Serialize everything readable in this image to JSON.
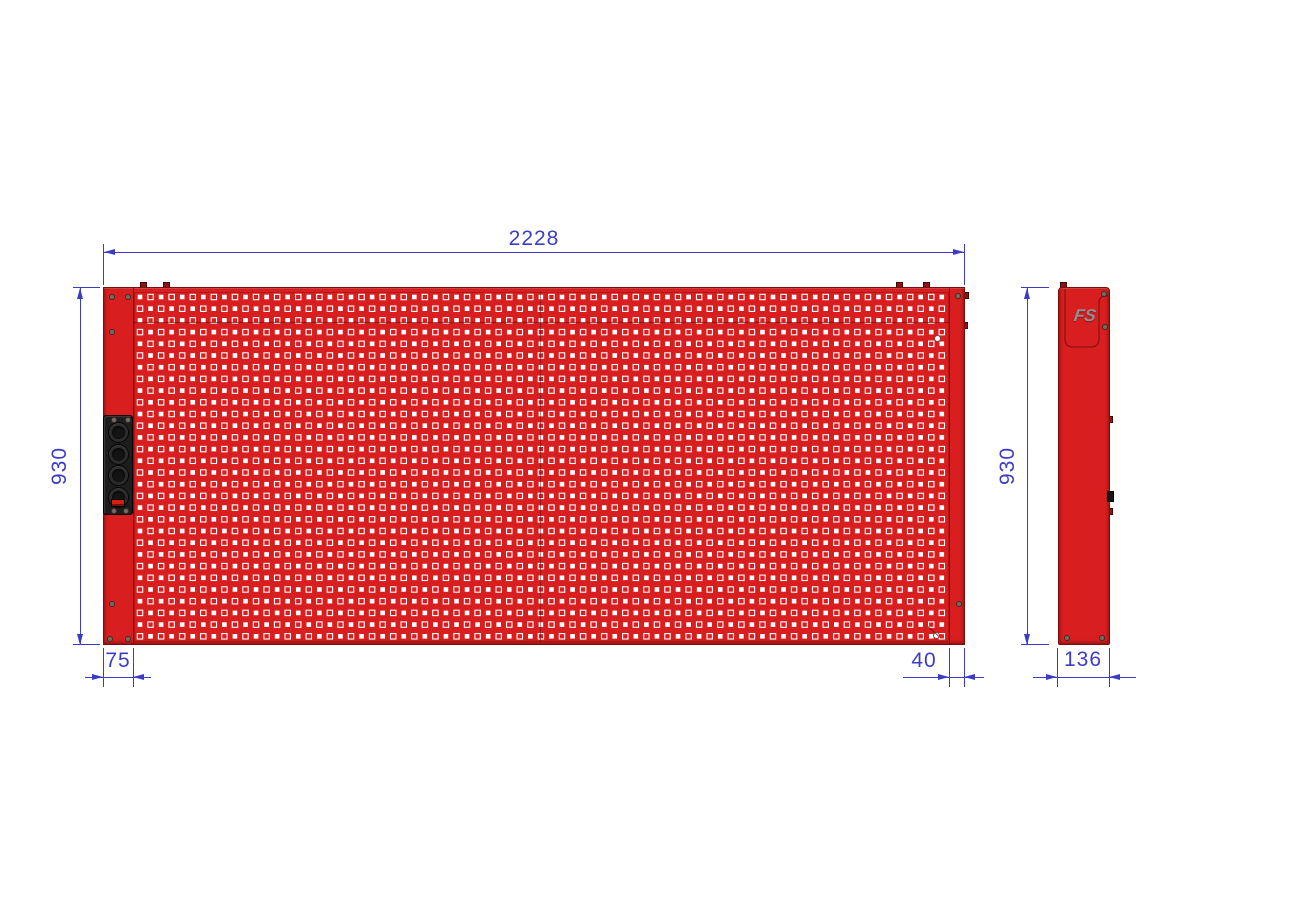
{
  "front_view": {
    "dim_width": "2228",
    "dim_height": "930",
    "dim_left_edge": "75",
    "dim_right_edge": "40",
    "power_strip": {
      "socket_count": 4
    }
  },
  "side_view": {
    "dim_height": "930",
    "dim_depth": "136",
    "logo_text": "FS"
  },
  "colors": {
    "background": "#ffffff",
    "panel_red": "#d81e1e",
    "panel_edge": "#7c0d0d",
    "dimension_blue": "#3c3cc8",
    "hole_white": "#ffffff",
    "power_strip_black": "#1d1d1d",
    "socket_dark": "#2b2b2b",
    "switch_red": "#d3200f",
    "logo_gray": "#8f9093",
    "screw_gray": "#7a6a60"
  }
}
